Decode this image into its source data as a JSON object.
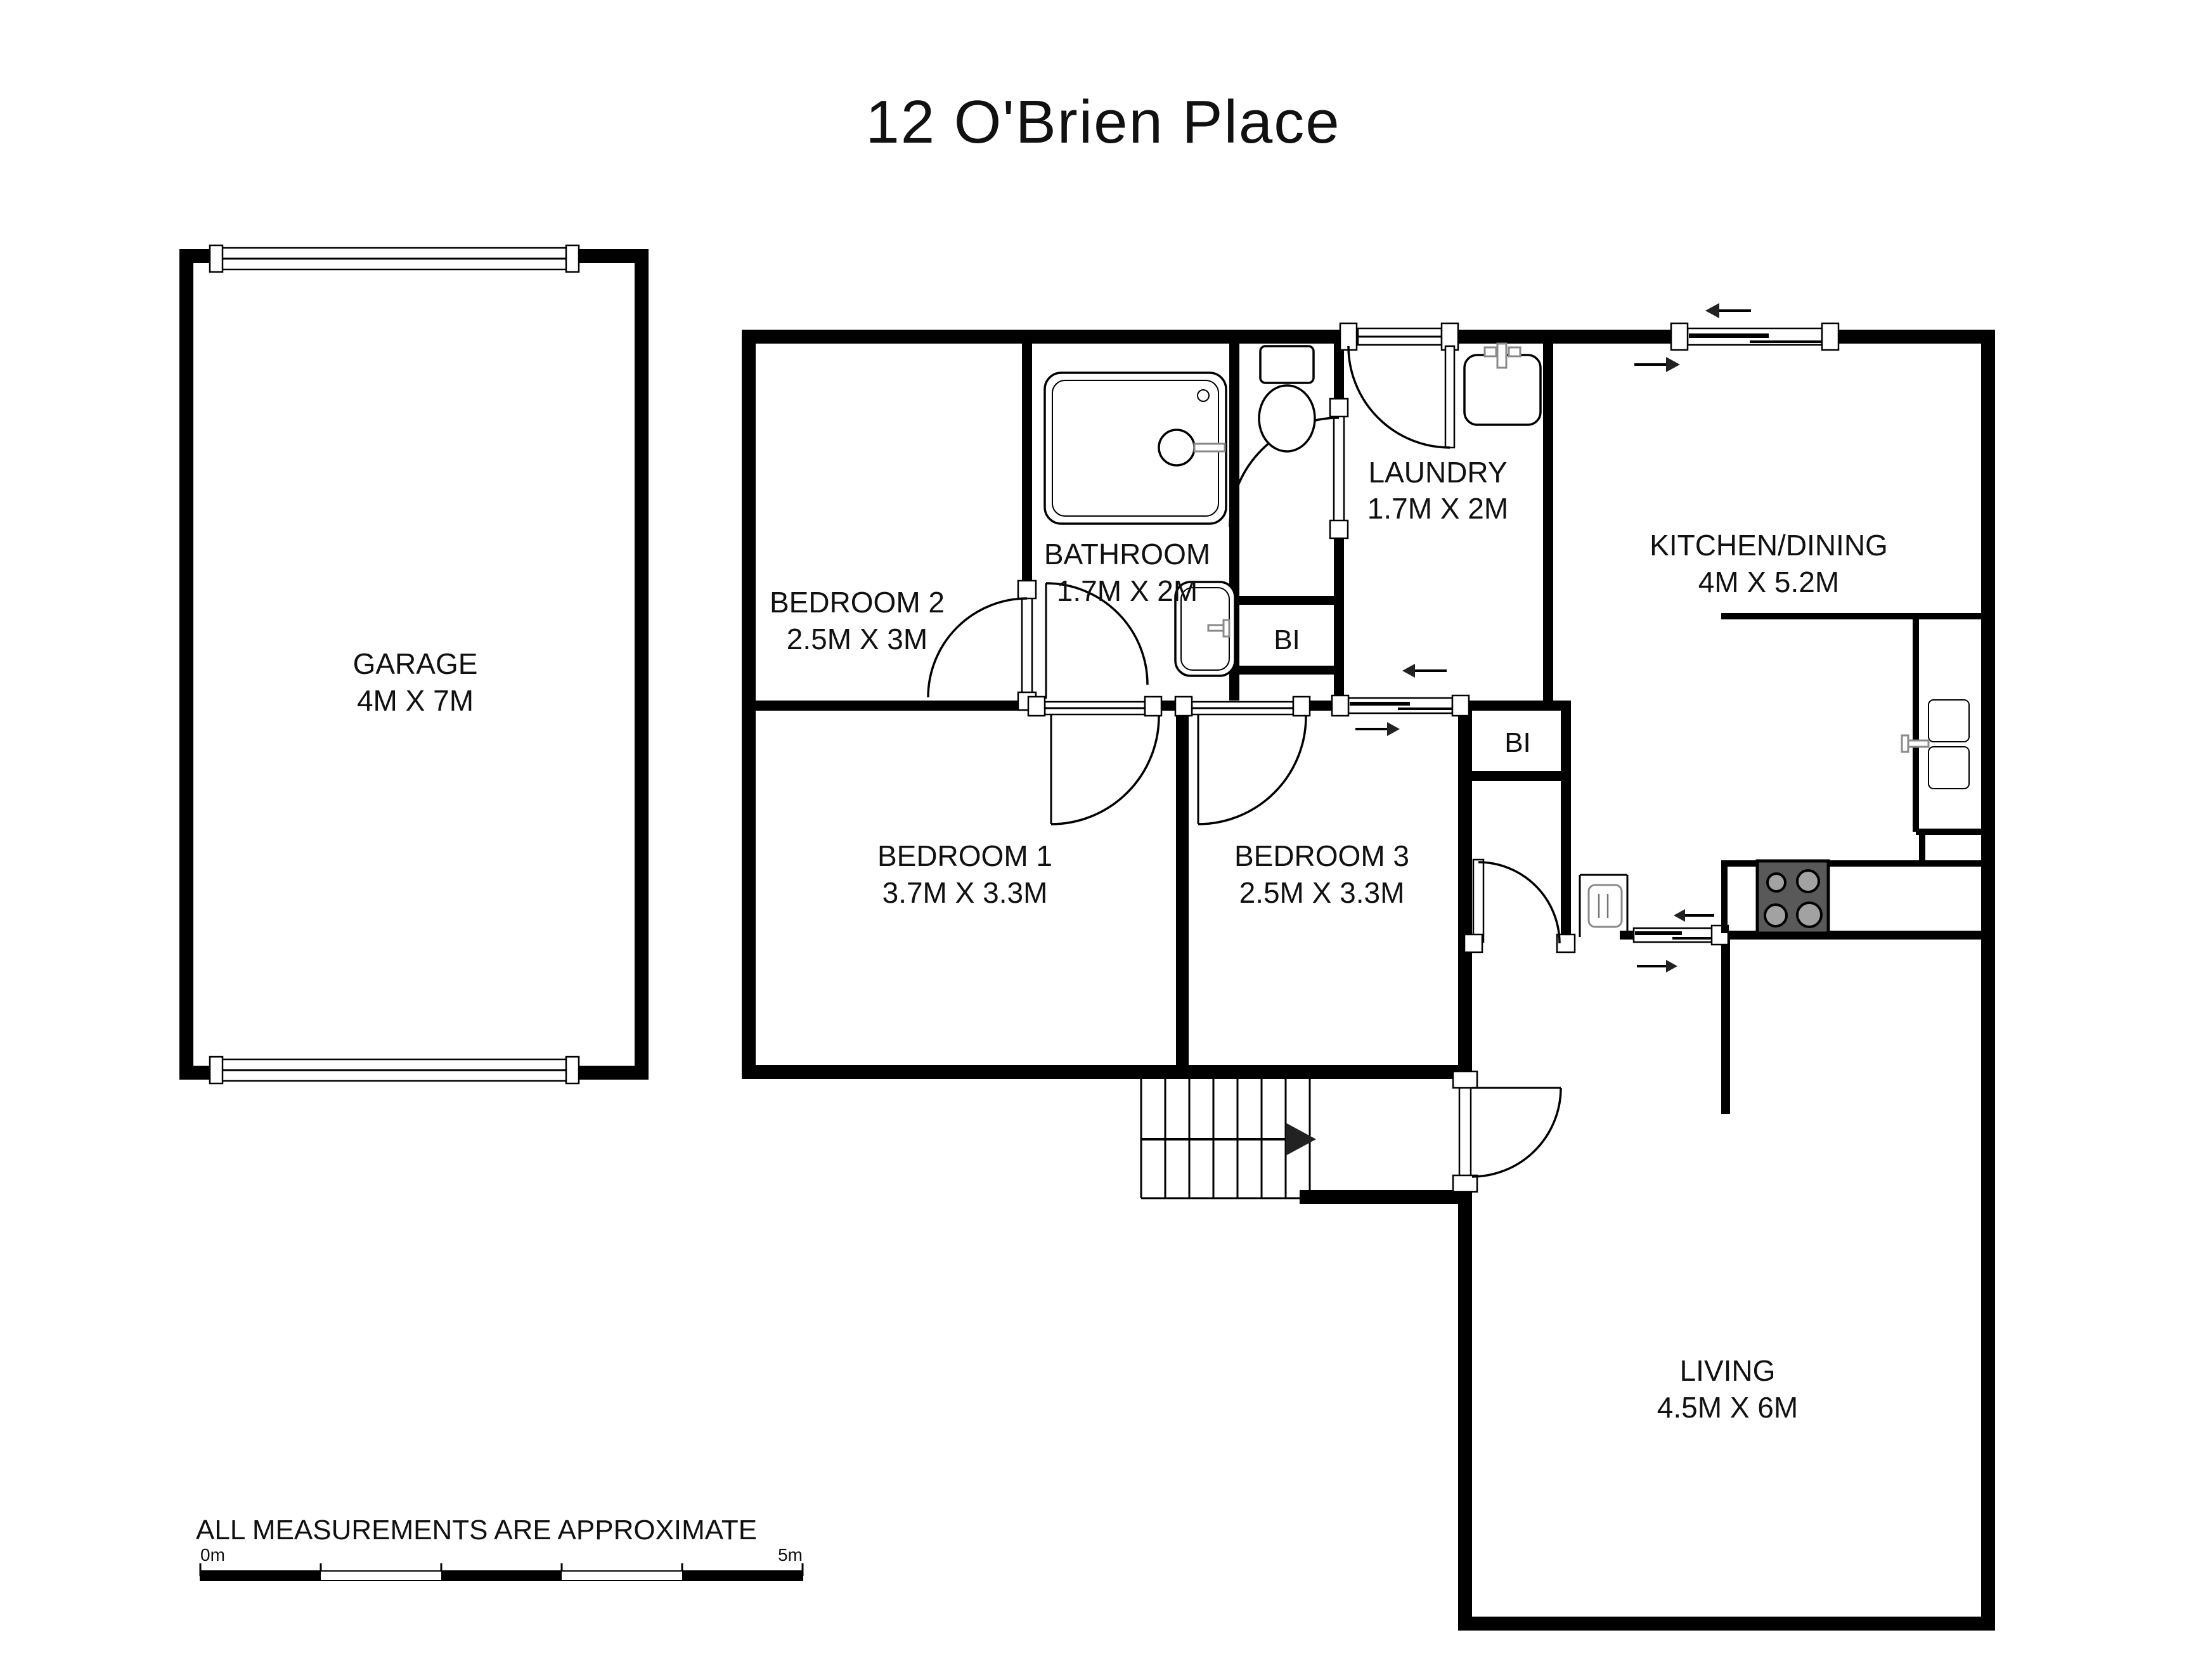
{
  "title": "12 O'Brien Place",
  "rooms": [
    {
      "id": "garage",
      "name": "GARAGE",
      "dims": "4M X 7M"
    },
    {
      "id": "bedroom2",
      "name": "BEDROOM 2",
      "dims": "2.5M X 3M"
    },
    {
      "id": "bathroom",
      "name": "BATHROOM",
      "dims": "1.7M X 2M"
    },
    {
      "id": "laundry",
      "name": "LAUNDRY",
      "dims": "1.7M X 2M"
    },
    {
      "id": "kitchen",
      "name": "KITCHEN/DINING",
      "dims": "4M X 5.2M"
    },
    {
      "id": "bedroom1",
      "name": "BEDROOM 1",
      "dims": "3.7M X 3.3M"
    },
    {
      "id": "bedroom3",
      "name": "BEDROOM 3",
      "dims": "2.5M X 3.3M"
    },
    {
      "id": "living",
      "name": "LIVING",
      "dims": "4.5M X 6M"
    }
  ],
  "closets": {
    "bi1": "BI",
    "bi2": "BI"
  },
  "footer": {
    "disclaimer": "ALL MEASUREMENTS ARE APPROXIMATE",
    "scale_start": "0m",
    "scale_end": "5m"
  }
}
